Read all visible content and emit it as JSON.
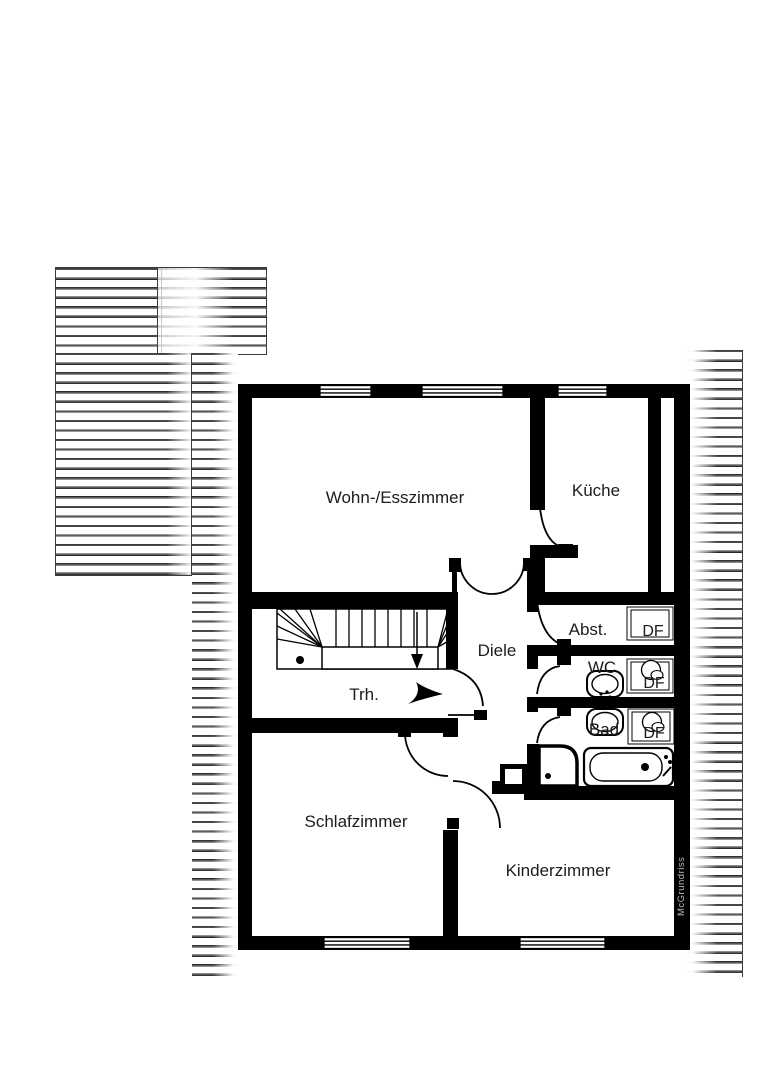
{
  "rooms": {
    "living_dining": {
      "label": "Wohn-/Esszimmer"
    },
    "kitchen": {
      "label": "Küche"
    },
    "storage": {
      "label": "Abst."
    },
    "wc": {
      "label": "WC"
    },
    "bath": {
      "label": "Bad"
    },
    "hallway": {
      "label": "Diele"
    },
    "stairwell": {
      "label": "Trh."
    },
    "bedroom": {
      "label": "Schlafzimmer"
    },
    "childrens_room": {
      "label": "Kinderzimmer"
    }
  },
  "roof_window": {
    "label": "DF"
  },
  "watermark": {
    "label": "McGrundriss"
  },
  "colors": {
    "wall": "#000000",
    "background": "#ffffff",
    "hatch_line": "#161616"
  }
}
